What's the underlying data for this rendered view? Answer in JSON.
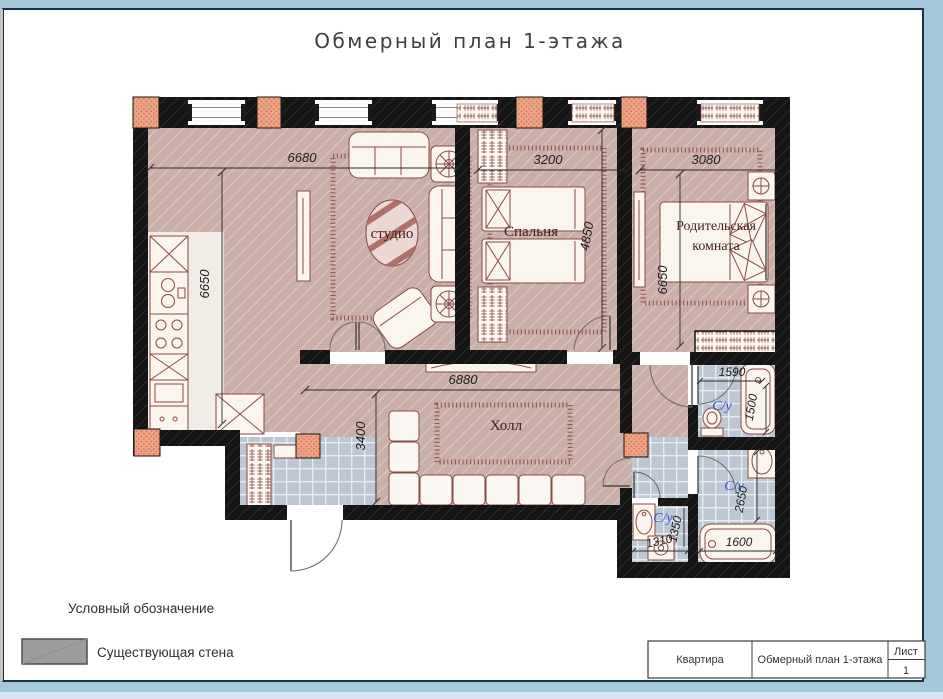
{
  "page": {
    "title": "Обмерный план 1-этажа"
  },
  "plan": {
    "rooms": {
      "studio": {
        "label": "студио",
        "width_mm": "6680",
        "height_mm": "6650"
      },
      "bedroom": {
        "label": "Спальня",
        "width_mm": "3200",
        "height_mm": "4850"
      },
      "parents": {
        "label_line1": "Родительская",
        "label_line2": "комната",
        "width_mm": "3080",
        "height_mm": "6650"
      },
      "hall": {
        "label": "Холл",
        "width_mm": "6880",
        "height_mm": "3400"
      },
      "bath_top": {
        "label": "С/у",
        "width_mm": "1590",
        "height_mm": "1500"
      },
      "bath_main": {
        "label": "С/у",
        "height_mm": "2650",
        "bath_width_mm": "1600"
      },
      "bath_small": {
        "label": "С/у",
        "width_mm": "1310",
        "height_mm": "1350"
      }
    },
    "colors": {
      "wall": "#171717",
      "floor": "#c9afa7",
      "tile": "#bcc7d3",
      "column": "#efa183",
      "furniture_outline": "#8a4a44",
      "bath_label": "#2b50c8",
      "frame": "#a3c8da"
    }
  },
  "legend": {
    "heading": "Условный обозначение",
    "existing_wall_label": "Существующая стена",
    "swatch_color": "#9c9c9c"
  },
  "title_block": {
    "object": "Квартира",
    "drawing": "Обмерный план 1-этажа",
    "sheet_label": "Лист",
    "sheet_number": "1"
  }
}
